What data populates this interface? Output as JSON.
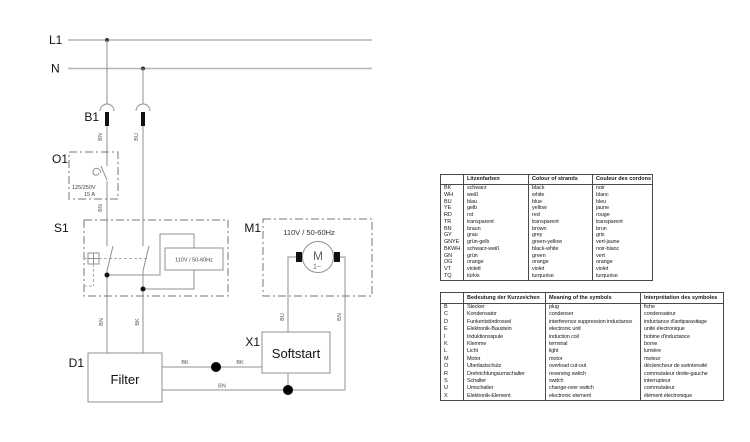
{
  "schematic": {
    "bus_labels": {
      "l1": "L1",
      "n": "N"
    },
    "component_labels": {
      "b1": "B1",
      "o1": "O1",
      "s1": "S1",
      "m1": "M1",
      "x1": "X1",
      "d1": "D1"
    },
    "boxes": {
      "filter": "Filter",
      "softstart": "Softstart"
    },
    "ratings": {
      "o1_voltage": "125/250V",
      "o1_current": "15 A",
      "s1_lamp": "110V / 50-60Hz",
      "m1": "110V /  50-60Hz"
    },
    "motor": {
      "letter": "M",
      "phase": "1~"
    },
    "wire_labels": {
      "b1_left": "BN",
      "b1_right": "BU",
      "o1_out": "BN",
      "s1_out_left": "BN",
      "s1_out_right": "BK",
      "m1_left": "BU",
      "m1_right": "BN",
      "filter_to_junction": "BK",
      "junction_to_softstart": "BK",
      "filter_neutral": "BN"
    }
  },
  "tables": {
    "colors": {
      "headers": [
        "",
        "Litzenfarben",
        "Colour of strands",
        "Couleur des cordons"
      ],
      "rows": [
        [
          "BK",
          "schwarz",
          "black",
          "noir"
        ],
        [
          "WH",
          "weiß",
          "white",
          "blanc"
        ],
        [
          "BU",
          "blau",
          "blue",
          "bleu"
        ],
        [
          "YE",
          "gelb",
          "yellow",
          "jaune"
        ],
        [
          "RD",
          "rot",
          "red",
          "rouge"
        ],
        [
          "TR",
          "transparent",
          "transparent",
          "transparent"
        ],
        [
          "BN",
          "braun",
          "brown",
          "brun"
        ],
        [
          "GY",
          "grau",
          "grey",
          "gris"
        ],
        [
          "GNYE",
          "grün-gelb",
          "green-yellow",
          "vert-jaune"
        ],
        [
          "BKWH",
          "schwarz-weiß",
          "black-white",
          "noir-blanc"
        ],
        [
          "GN",
          "grün",
          "green",
          "vert"
        ],
        [
          "OG",
          "orange",
          "orange",
          "orange"
        ],
        [
          "VT",
          "violett",
          "violet",
          "violet"
        ],
        [
          "TQ",
          "türkis",
          "turquoise",
          "turquoise"
        ]
      ]
    },
    "symbols": {
      "headers": [
        "",
        "Bedeutung der Kurzzeichen",
        "Meaning of the symbols",
        "Interprétation des symboles"
      ],
      "rows": [
        [
          "B",
          "Stecker",
          "plug",
          "fiche"
        ],
        [
          "C",
          "Kondensator",
          "condenser",
          "condensateur"
        ],
        [
          "D",
          "Funkentstördrossel",
          "interference suppression inductance",
          "inductance d'antiparasitage"
        ],
        [
          "E",
          "Elektronik-Baustein",
          "electronic unit",
          "unité électronique"
        ],
        [
          "I",
          "Induktionsspule",
          "induction coil",
          "bobine d'inductance"
        ],
        [
          "K",
          "Klemme",
          "terminal",
          "borne"
        ],
        [
          "L",
          "Licht",
          "light",
          "lumière"
        ],
        [
          "M",
          "Motor",
          "motor",
          "moteur"
        ],
        [
          "O",
          "Überlastschutz",
          "overload cut-out",
          "déclencheur de surintensité"
        ],
        [
          "R",
          "Drehrichtungsumschalter",
          "reversing switch",
          "commutateur droite-gauche"
        ],
        [
          "S",
          "Schalter",
          "switch",
          "interrupteur"
        ],
        [
          "U",
          "Umschalter",
          "change-over switch",
          "commutateur"
        ],
        [
          "X",
          "Elektronik-Element",
          "electronic element",
          "élément électronique"
        ]
      ]
    }
  }
}
